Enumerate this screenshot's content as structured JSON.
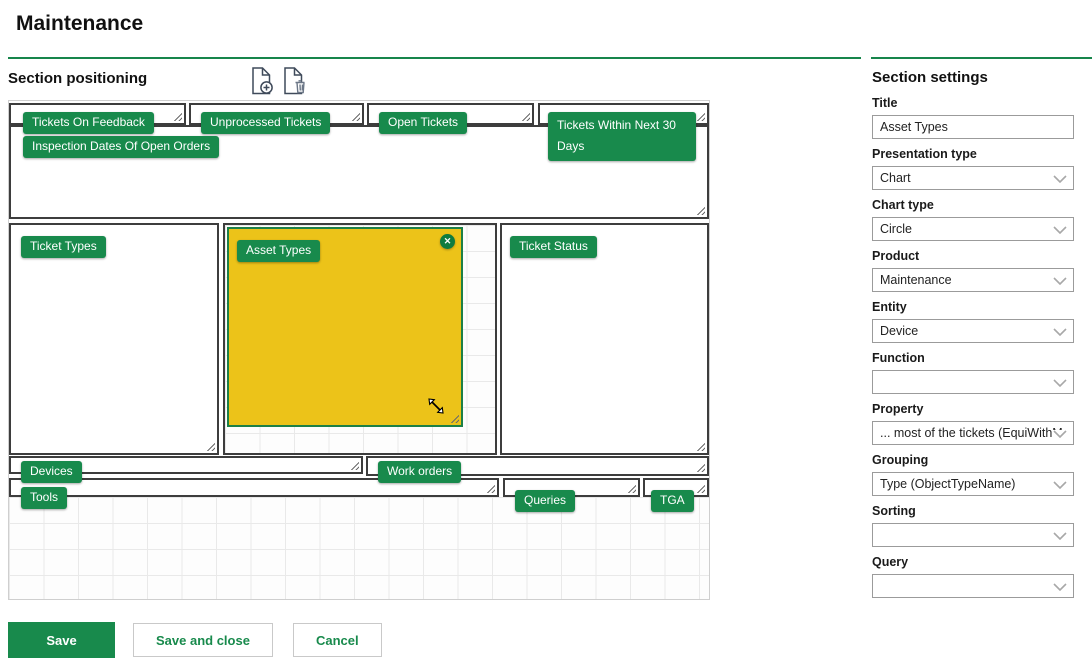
{
  "page": {
    "title": "Maintenance"
  },
  "positioning": {
    "heading": "Section positioning",
    "add_icon": "add-section-icon",
    "delete_icon": "delete-section-icon"
  },
  "tiles": [
    {
      "label": "Tickets On Feedback"
    },
    {
      "label": "Unprocessed Tickets"
    },
    {
      "label": "Open Tickets"
    },
    {
      "label": "Tickets Within Next 30 Days"
    },
    {
      "label": "Inspection Dates Of Open Orders"
    },
    {
      "label": "Ticket Types"
    },
    {
      "label": "Asset Types",
      "selected": true
    },
    {
      "label": "Ticket Status"
    },
    {
      "label": "Devices"
    },
    {
      "label": "Work orders"
    },
    {
      "label": "Tools"
    },
    {
      "label": "Queries"
    },
    {
      "label": "TGA"
    }
  ],
  "settings": {
    "heading": "Section settings",
    "title": {
      "label": "Title",
      "value": "Asset Types"
    },
    "presentation_type": {
      "label": "Presentation type",
      "value": "Chart"
    },
    "chart_type": {
      "label": "Chart type",
      "value": "Circle"
    },
    "product": {
      "label": "Product",
      "value": "Maintenance"
    },
    "entity": {
      "label": "Entity",
      "value": "Device"
    },
    "function": {
      "label": "Function",
      "value": ""
    },
    "property": {
      "label": "Property",
      "value": "... most of the tickets (EquiWithM"
    },
    "grouping": {
      "label": "Grouping",
      "value": "Type (ObjectTypeName)"
    },
    "sorting": {
      "label": "Sorting",
      "value": ""
    },
    "query": {
      "label": "Query",
      "value": ""
    }
  },
  "actions": {
    "save": "Save",
    "save_and_close": "Save and close",
    "cancel": "Cancel"
  },
  "ui": {
    "close_glyph": "✕"
  },
  "colors": {
    "accent_green": "#188a4c",
    "selected_yellow": "#ecc319",
    "selected_border": "#1d8046",
    "tile_border": "#3d3d3d",
    "underline_green": "#17854b"
  }
}
